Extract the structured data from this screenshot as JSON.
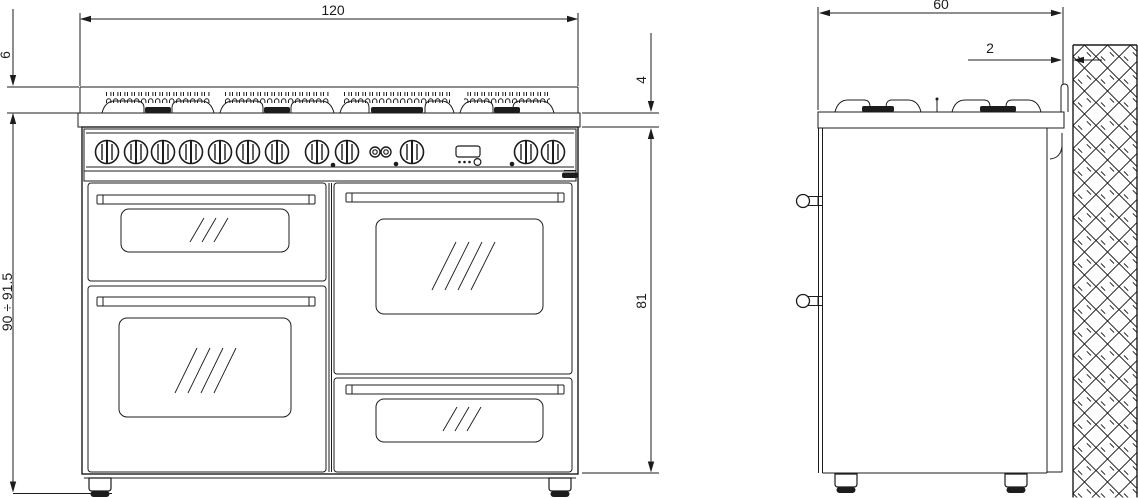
{
  "drawing": {
    "background": "#ffffff",
    "line_color": "#1c1c1c",
    "front_view": {
      "dim_width": "120",
      "dim_grate_height": "6",
      "dim_hob_edge_height": "4",
      "dim_overall_height": "90 ÷ 91.5",
      "dim_body_height": "81"
    },
    "side_view": {
      "dim_depth": "60",
      "dim_wall_gap": "2"
    }
  }
}
